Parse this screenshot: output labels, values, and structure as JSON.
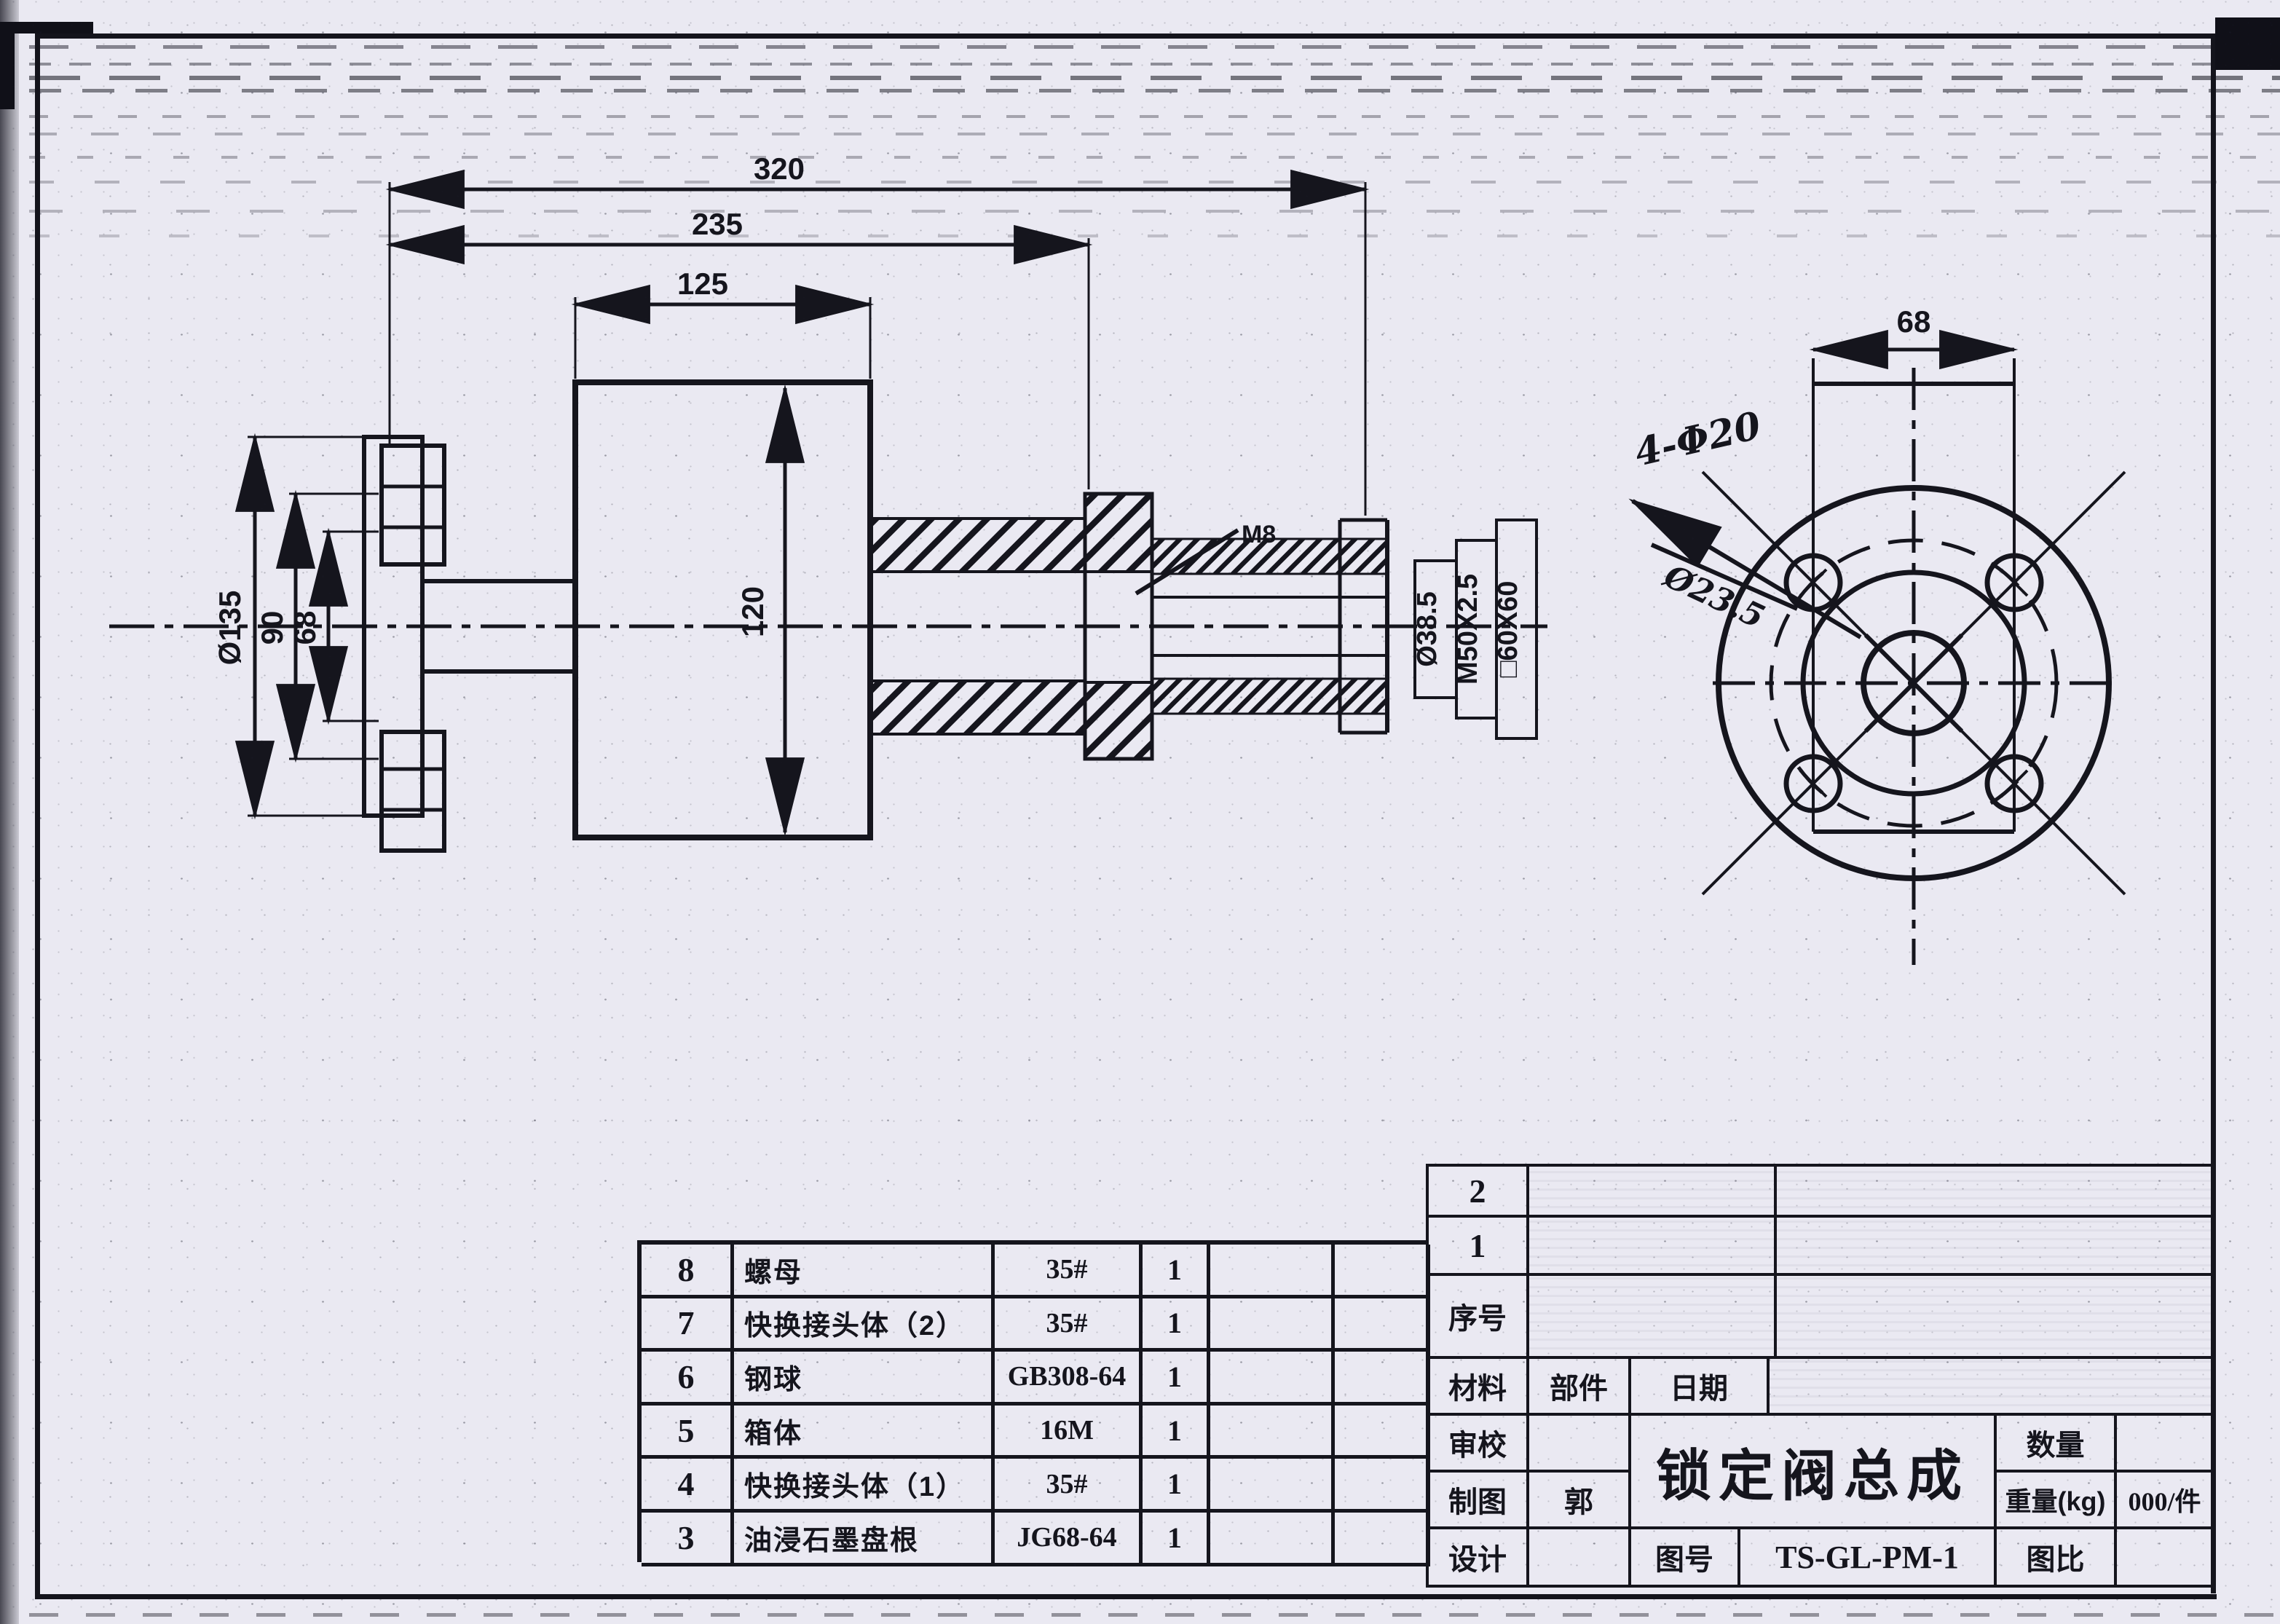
{
  "annotations": {
    "dim_total_length": "320",
    "dim_mid_length": "235",
    "dim_body_width": "125",
    "dim_body_height": "120",
    "dim_flange_od": "Ø135",
    "dim_bolt_circle": "90",
    "dim_bolt_span": "68",
    "dim_bore": "Ø38.5",
    "dim_thread": "M50X2.5",
    "dim_square_end": "□60X60",
    "dim_front_span": "68",
    "note_holes": "4-Φ20",
    "note_struck": "Ø23.5",
    "note_leader": "M8"
  },
  "parts_table": {
    "rows": [
      {
        "no": "8",
        "name": "螺母",
        "material": "35#",
        "qty": "1"
      },
      {
        "no": "7",
        "name": "快换接头体（2）",
        "material": "35#",
        "qty": "1"
      },
      {
        "no": "6",
        "name": "钢球",
        "material": "GB308-64",
        "qty": "1"
      },
      {
        "no": "5",
        "name": "箱体",
        "material": "16M",
        "qty": "1"
      },
      {
        "no": "4",
        "name": "快换接头体（1）",
        "material": "35#",
        "qty": "1"
      },
      {
        "no": "3",
        "name": "油浸石墨盘根",
        "material": "JG68-64",
        "qty": "1"
      }
    ]
  },
  "title_block": {
    "index_rows": [
      "2",
      "1"
    ],
    "index_label": "序号",
    "material_label": "材料",
    "part_label": "部件",
    "date_label": "日期",
    "review_label": "审校",
    "draft_label": "制图",
    "draftsman": "郭",
    "design_label": "设计",
    "main_title": "锁定阀总成",
    "qty_label": "数量",
    "weight_label": "重量(kg)",
    "weight_value": "000/件",
    "fig_no_label": "图号",
    "fig_no_value": "TS-GL-PM-1",
    "scale_label": "图比"
  }
}
